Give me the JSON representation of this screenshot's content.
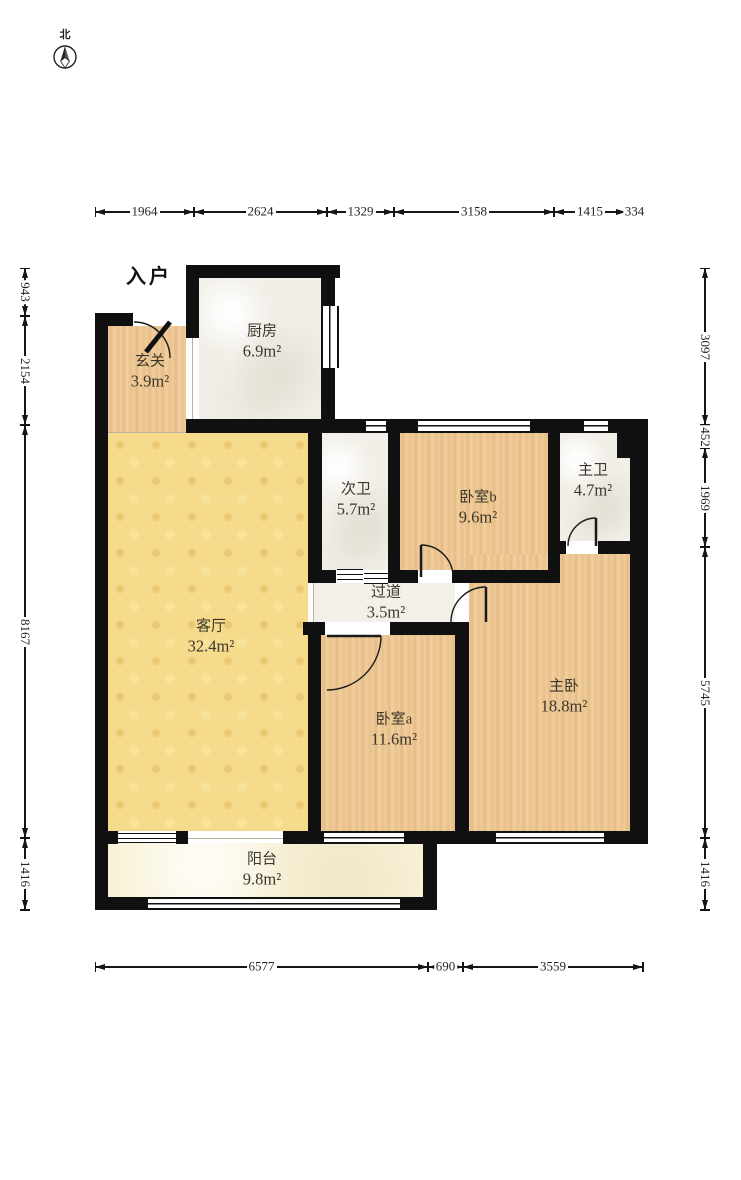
{
  "compass": {
    "north": "北"
  },
  "entrance": {
    "label": "入户"
  },
  "rooms": {
    "entry_hall": {
      "name": "玄关",
      "area": "3.9m²"
    },
    "kitchen": {
      "name": "厨房",
      "area": "6.9m²"
    },
    "second_bathroom": {
      "name": "次卫",
      "area": "5.7m²"
    },
    "bedroom_b": {
      "name": "卧室b",
      "area": "9.6m²"
    },
    "master_bathroom": {
      "name": "主卫",
      "area": "4.7m²"
    },
    "living_room": {
      "name": "客厅",
      "area": "32.4m²"
    },
    "hallway": {
      "name": "过道",
      "area": "3.5m²"
    },
    "bedroom_a": {
      "name": "卧室a",
      "area": "11.6m²"
    },
    "master_bedroom": {
      "name": "主卧",
      "area": "18.8m²"
    },
    "balcony": {
      "name": "阳台",
      "area": "9.8m²"
    }
  },
  "dimensions_mm": {
    "top": [
      "1964",
      "2624",
      "1329",
      "3158",
      "1415",
      "334"
    ],
    "bottom": [
      "6577",
      "690",
      "3559"
    ],
    "left": [
      "943",
      "2154",
      "8167",
      "1416"
    ],
    "right": [
      "3097",
      "452",
      "1969",
      "5745",
      "1416"
    ]
  },
  "colors": {
    "wall": "#101010",
    "wood_floor": "#ecc794",
    "tile_floor": "#f2efe8",
    "living_floor": "#f6db8c",
    "balcony_floor": "#f9f2d8"
  }
}
